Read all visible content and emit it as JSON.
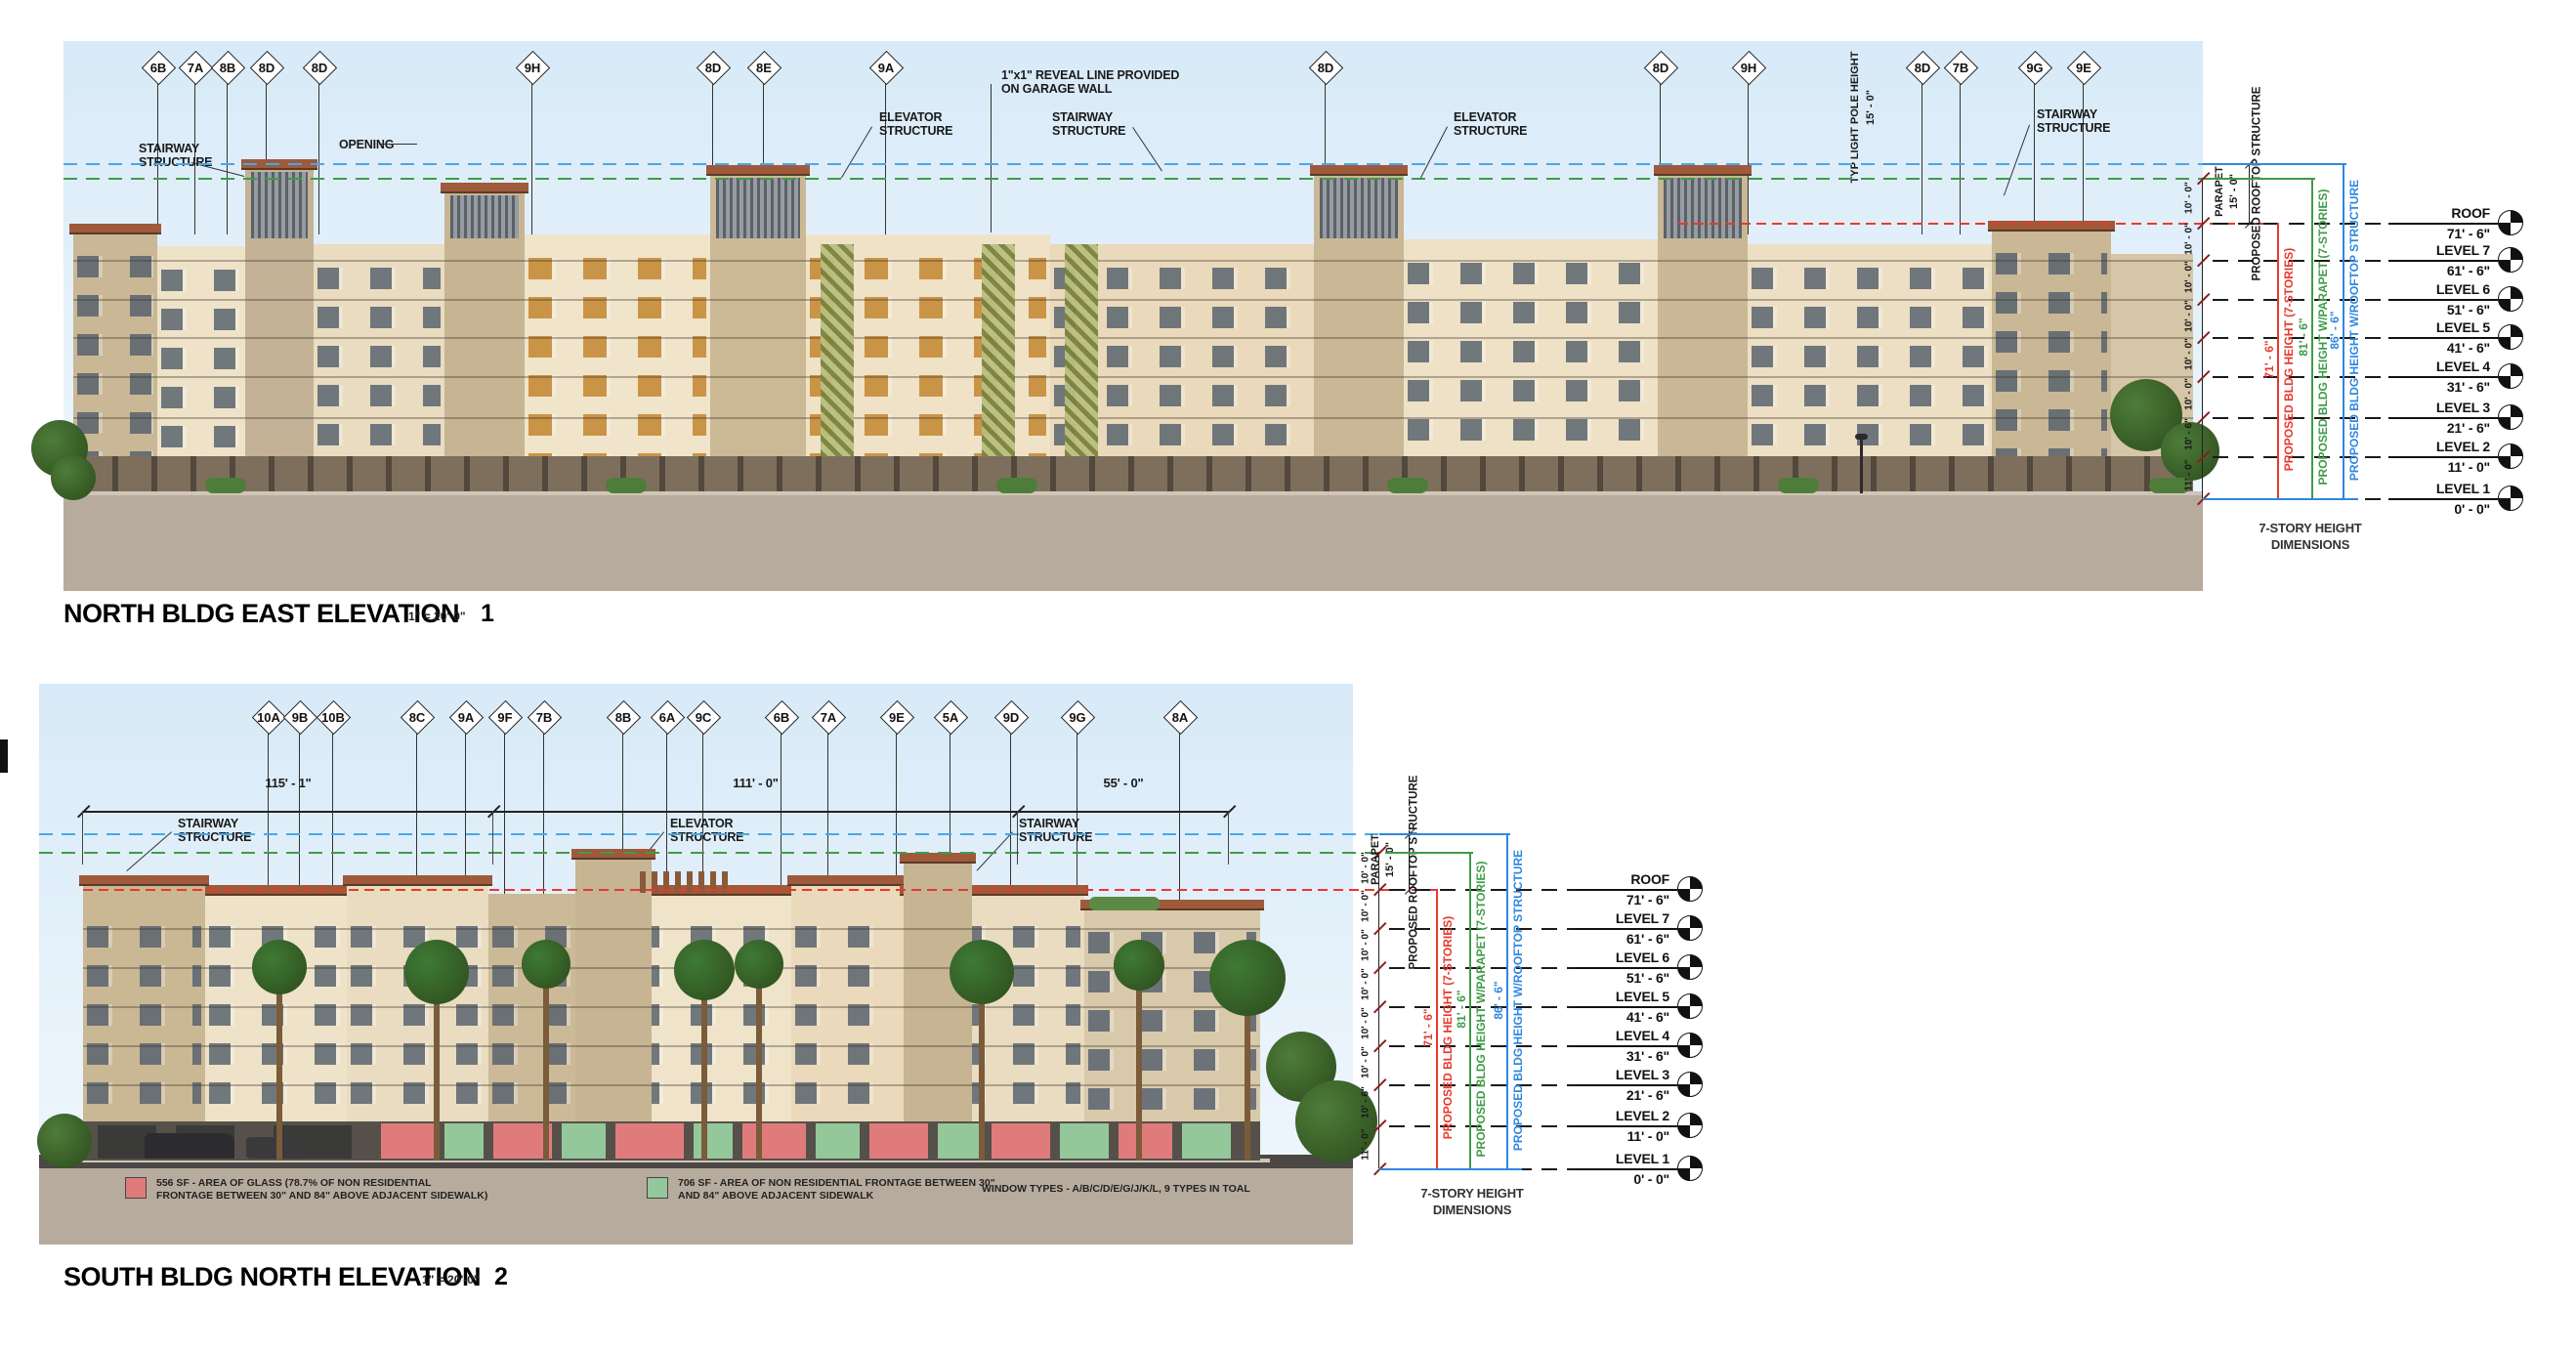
{
  "colors": {
    "sky_top": "#d8eaf8",
    "sky_bottom": "#eef6fc",
    "ground": "#b7ab9d",
    "street": "#4a4745",
    "facade_cream": "#eee2c8",
    "facade_tan": "#c9b795",
    "base_brown": "#7e6f5d",
    "roof_cap": "#9e5a3b",
    "roof_cap_shadow": "#5c3a26",
    "window_gray": "#54606c",
    "window_orange": "#c68d3c",
    "lattice_olive": "#9aa356",
    "dim_red": "#e8392e",
    "dim_green": "#3f9b48",
    "dim_blue": "#2f87e0",
    "sky_dash_blue": "#47a7e8",
    "legend_red": "#e07b7b",
    "legend_green": "#94c79a",
    "tree_green": "#4e7d3a",
    "palm_green": "#3e7a35"
  },
  "levels": [
    {
      "name": "ROOF",
      "elev": "71' - 6\""
    },
    {
      "name": "LEVEL 7",
      "elev": "61' - 6\""
    },
    {
      "name": "LEVEL 6",
      "elev": "51' - 6\""
    },
    {
      "name": "LEVEL 5",
      "elev": "41' - 6\""
    },
    {
      "name": "LEVEL 4",
      "elev": "31' - 6\""
    },
    {
      "name": "LEVEL 3",
      "elev": "21' - 6\""
    },
    {
      "name": "LEVEL 2",
      "elev": "11' - 0\""
    },
    {
      "name": "LEVEL 1",
      "elev": "0' - 0\""
    }
  ],
  "floor_dims": [
    "10' - 0\"",
    "10' - 0\"",
    "10' - 0\"",
    "10' - 0\"",
    "10' - 0\"",
    "10' - 0\"",
    "10' - 6\"",
    "11' - 0\""
  ],
  "height_annotations": {
    "parapet_label": "PARAPET",
    "parapet_dim": "15' - 0\"",
    "rooftop_label": "PROPOSED ROOFTOP STRUCTURE",
    "bldg_height_label": "PROPOSED BLDG HEIGHT (7-STORIES)",
    "bldg_height_dim": "71' - 6\"",
    "parapet_height_label": "PROPOSED BLDG HEIGHT W/PARAPET (7-STORIES)",
    "parapet_height_dim": "81' - 6\"",
    "rooftop_height_label": "PROPOSED BLDG HEIGHT W/ROOFTOP STRUCTURE",
    "rooftop_height_dim": "86' - 6\"",
    "caption_line1": "7-STORY HEIGHT",
    "caption_line2": "DIMENSIONS"
  },
  "elevation1": {
    "title": "NORTH BLDG EAST ELEVATION",
    "scale": "1\" = 20'-0\"",
    "number": "1",
    "markers": [
      "6B",
      "7A",
      "8B",
      "8D",
      "8D",
      "9H",
      "8D",
      "8E",
      "9A",
      "8D",
      "8D",
      "9H",
      "8D",
      "7B",
      "9G",
      "9E"
    ],
    "annotations": [
      [
        "STAIRWAY",
        "STRUCTURE"
      ],
      [
        "OPENING"
      ],
      [
        "ELEVATOR",
        "STRUCTURE"
      ],
      [
        "1\"x1\" REVEAL LINE PROVIDED",
        "ON GARAGE WALL"
      ],
      [
        "STAIRWAY",
        "STRUCTURE"
      ],
      [
        "ELEVATOR",
        "STRUCTURE"
      ],
      [
        "STAIRWAY",
        "STRUCTURE"
      ]
    ],
    "pole_dim": "15' - 0\"",
    "pole_label": "TYP LIGHT POLE HEIGHT"
  },
  "elevation2": {
    "title": "SOUTH BLDG NORTH ELEVATION",
    "scale": "1\" = 20'-0\"",
    "number": "2",
    "markers": [
      "10A",
      "9B",
      "10B",
      "8C",
      "9A",
      "9F",
      "7B",
      "8B",
      "6A",
      "9C",
      "6B",
      "7A",
      "9E",
      "5A",
      "9D",
      "9G",
      "8A"
    ],
    "dim_segments": [
      "115' - 1\"",
      "111' - 0\"",
      "55' - 0\""
    ],
    "annotations": [
      [
        "STAIRWAY",
        "STRUCTURE"
      ],
      [
        "ELEVATOR",
        "STRUCTURE"
      ],
      [
        "STAIRWAY",
        "STRUCTURE"
      ]
    ]
  },
  "legend": {
    "red_label_line1": "556 SF - AREA OF GLASS (78.7% OF NON RESIDENTIAL",
    "red_label_line2": "FRONTAGE BETWEEN 30\" AND 84\" ABOVE ADJACENT SIDEWALK)",
    "green_label_line1": "706 SF - AREA OF NON RESIDENTIAL FRONTAGE BETWEEN 30\"",
    "green_label_line2": "AND 84\" ABOVE ADJACENT SIDEWALK",
    "window_types_note": "WINDOW TYPES - A/B/C/D/E/G/J/K/L, 9 TYPES IN TOAL"
  }
}
